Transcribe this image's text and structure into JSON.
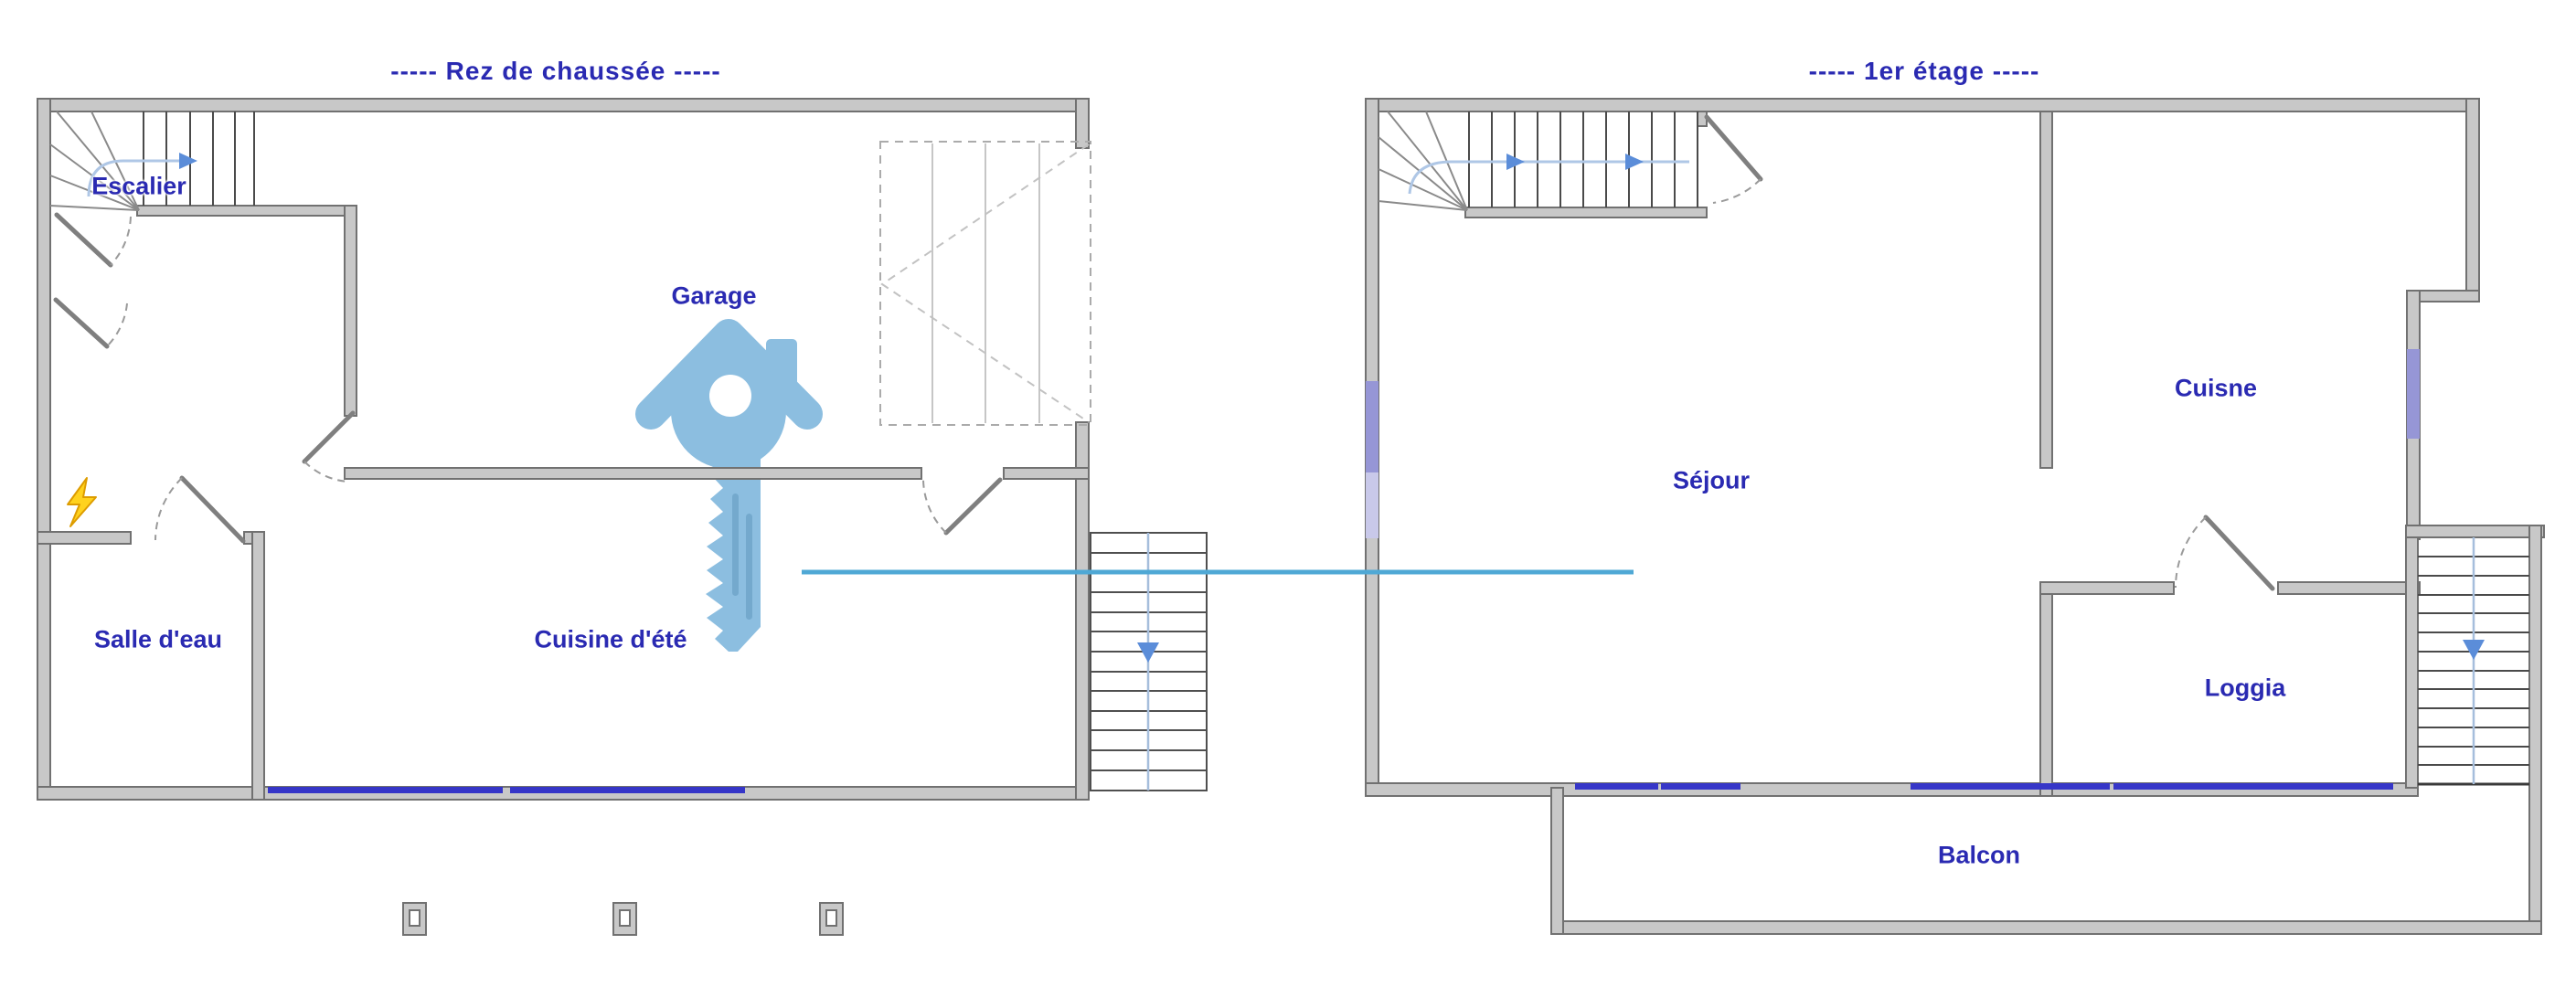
{
  "document": {
    "type": "floor-plan-drawing",
    "background": "#FFFFFF"
  },
  "plans": {
    "ground": {
      "title": "-----  Rez de chaussée  -----",
      "rooms": [
        {
          "label": "Escalier"
        },
        {
          "label": "Garage"
        },
        {
          "label": "Salle d'eau"
        },
        {
          "label": "Cuisine d'été"
        }
      ]
    },
    "first": {
      "title": "-----  1er étage  -----",
      "rooms": [
        {
          "label": "Séjour"
        },
        {
          "label": "Cuisne"
        },
        {
          "label": "Loggia"
        },
        {
          "label": "Balcon"
        }
      ]
    }
  },
  "icons": {
    "watermark": "house-key-watermark",
    "electric": "lightning-bolt-icon",
    "stair_direction": "blue-direction-arrows"
  },
  "colors": {
    "label_blue": "#2A2AB2",
    "wall_fill": "#C8C8C8",
    "wall_edge": "#717171",
    "tread_line": "#4A4A4A",
    "window_blue": "#3636C8",
    "window_light_purple": "#9696D6",
    "stair_arrow_blue": "#5B8DD9",
    "stair_path_blue": "#AFC7E6",
    "watermark_key_blue": "#8CBEE0",
    "watermark_line_blue": "#4FA8D5",
    "bolt_yellow": "#FFD21E"
  }
}
